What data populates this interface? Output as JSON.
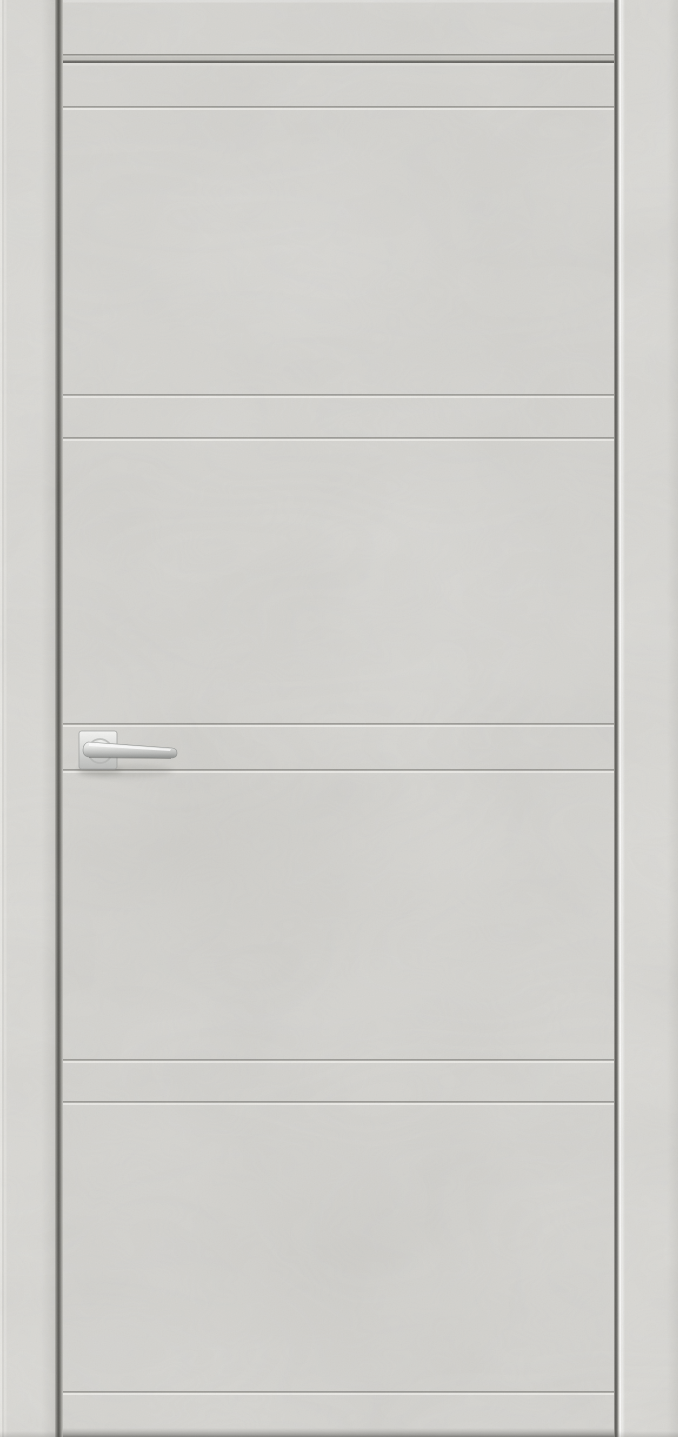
{
  "scene": {
    "description": "Product photograph of a closed flush interior door with a light grey concrete-look finish, horizontal milled groove lines and a chrome lever handle on a square rose, set in a matching light grey flat casing frame",
    "text_content": "none — image contains no visible text",
    "objects": [
      "door-frame-casing",
      "door-leaf",
      "horizontal-grooves",
      "chrome-lever-handle"
    ]
  },
  "palette": {
    "casing": "#dad9d5",
    "casing_top": "#d6d5d1",
    "door_face": "#d5d4d0",
    "groove_dark": "#9c9b96",
    "groove_light": "#e9e8e4",
    "seam_dark": "#4f4e4a",
    "edge_highlight": "#f6f5f1",
    "bottom_shade": "#aaa9a5",
    "handle_chrome_light": "#f7f7f5",
    "handle_chrome_mid": "#d0d1cf",
    "handle_chrome_dark": "#8e908e",
    "handle_shadow": "rgba(60,60,56,0.15)"
  },
  "layout": {
    "image": {
      "width": 678,
      "height": 1437
    },
    "left_casing": {
      "x": 0,
      "width": 55
    },
    "left_seam": {
      "x": 55,
      "width": 8
    },
    "door": {
      "x": 63,
      "width": 551,
      "top_y": 63
    },
    "right_seam": {
      "x": 614,
      "width": 8
    },
    "right_casing": {
      "x": 622,
      "width": 56
    },
    "top_casing_height": 54,
    "top_reveal_height": 9
  },
  "door": {
    "groove_count": 8,
    "grooves": [
      {
        "y": 107
      },
      {
        "y": 395
      },
      {
        "y": 438
      },
      {
        "y": 724
      },
      {
        "y": 770
      },
      {
        "y": 1060
      },
      {
        "y": 1102
      },
      {
        "y": 1392
      }
    ]
  },
  "handle": {
    "type": "square-rose chrome lever, pointing right",
    "rose": {
      "x": 79,
      "y": 731,
      "size": 38
    },
    "lever_tip_x": 177
  }
}
